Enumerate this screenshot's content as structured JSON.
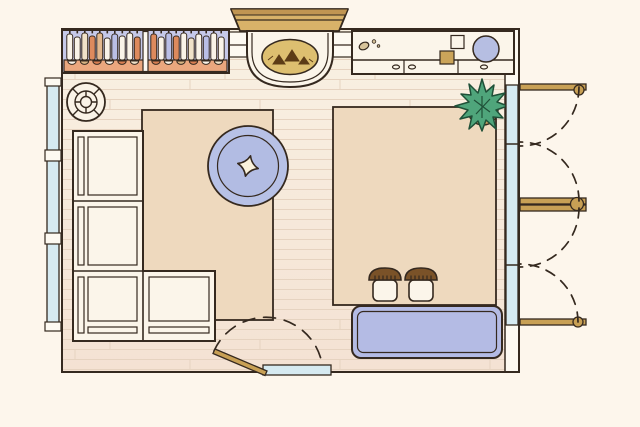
{
  "scene": {
    "type": "floor-plan",
    "view": "top-down",
    "width_px": 640,
    "height_px": 427
  },
  "labels": {
    "room": "living-room-floor-plan",
    "bookshelf": "bookshelf-with-books",
    "fireplace": "fireplace-with-logs",
    "console": "console-cabinet-with-drawers",
    "plant": "potted-plant",
    "sofa": "l-shaped-sectional-sofa",
    "round_rug": "round-rug-with-star",
    "rug_left": "area-rug-left",
    "rug_right": "area-rug-right",
    "side_table": "round-side-table",
    "bench": "upholstered-bench",
    "stools": "pair-of-stools",
    "window_left": "window-left-wall",
    "french_doors": "double-french-doors-right",
    "entry_door": "entry-door-bottom"
  },
  "palette": {
    "outside": "#fdf6ec",
    "outline": "#35291f",
    "floor_top": "#f9f1e3",
    "floor_bottom": "#f4e2d3",
    "plank_line": "#e6d3c0",
    "wall_fill": "#fdf9f1",
    "rug": "#eed9be",
    "round_rug": "#b7c1e6",
    "round_rug_inner": "#b2bce3",
    "star": "#faf2dc",
    "glazing": "#d6eaf1",
    "wood": "#c8a055",
    "mantel": "#d8b269",
    "mantel_band": "#c09552",
    "firebox": "#ddbf70",
    "log": "#5c3c16",
    "white_furniture": "#fbf5ea",
    "shelf_bg": "#c6c9e9",
    "shelf_strip": "#eba77e",
    "bench": "#b4bbe4",
    "plant": "#4fa57b",
    "plant_dark": "#1f5038",
    "pot": "#c39a5e",
    "stool_cap": "#7a5228",
    "gold_square": "#cba45a",
    "pebble": "#d8c49a",
    "bowl_circle": "#b6bee2"
  },
  "bookshelf": {
    "sections": [
      {
        "books": [
          "white",
          "white",
          "cream",
          "orange",
          "tan",
          "white",
          "lavender",
          "white",
          "white",
          "orange"
        ]
      },
      {
        "books": [
          "orange",
          "white",
          "lavender",
          "orange",
          "white",
          "cream",
          "white",
          "lavender",
          "white",
          "white"
        ]
      }
    ],
    "book_colors": {
      "white": "#f9f3e8",
      "cream": "#f0e2c9",
      "orange": "#dd8a5d",
      "tan": "#e3b98f",
      "lavender": "#b9bee6"
    },
    "bowls": [
      {
        "section": 0,
        "items": [
          "white",
          "tan",
          "orange",
          "white",
          "orange",
          "cream"
        ]
      },
      {
        "section": 1,
        "items": [
          "orange",
          "white",
          "tan",
          "orange",
          "white",
          "cream"
        ]
      }
    ],
    "bowl_colors": {
      "white": "#f9f3e8",
      "cream": "#f0e2c9",
      "orange": "#d97f52",
      "tan": "#d9b483"
    }
  },
  "counts": {
    "french_door_leaves": 4,
    "stools": 2,
    "sofa_seats": 4,
    "window_panes": 3
  }
}
